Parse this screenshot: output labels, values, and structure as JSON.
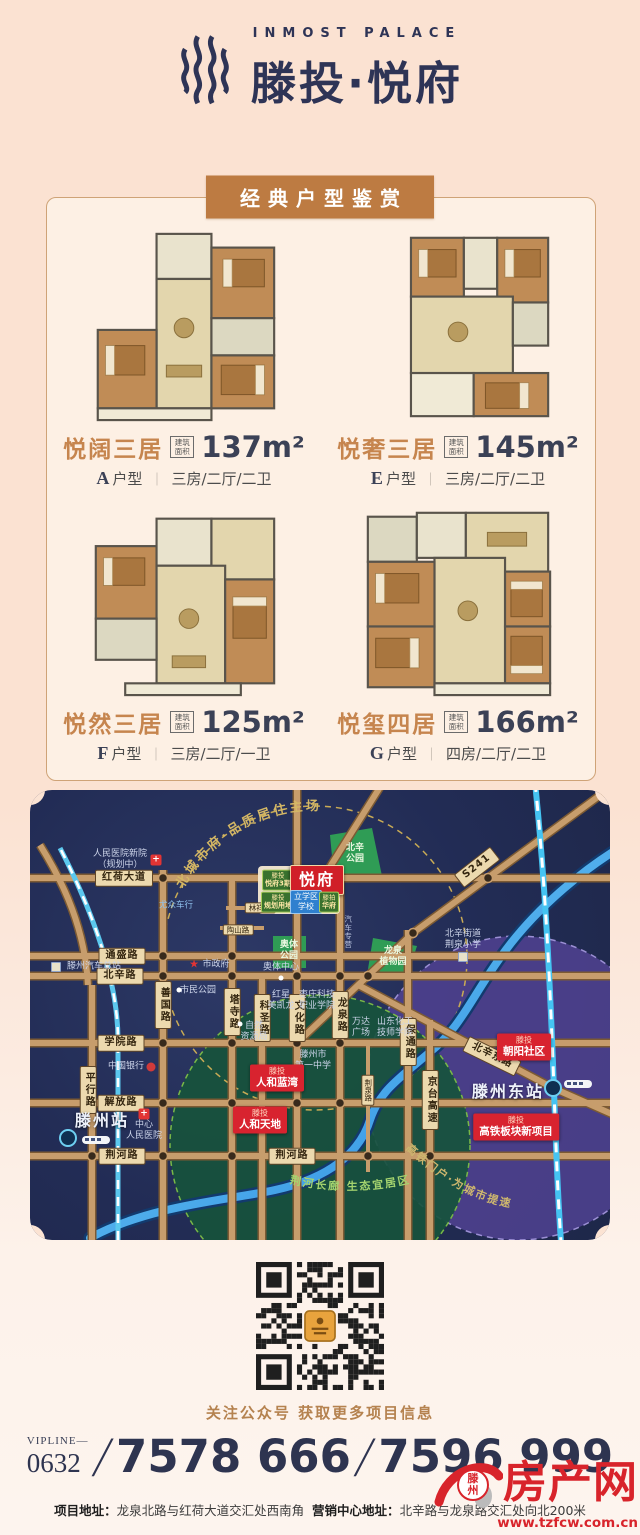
{
  "header": {
    "logo_en": "INMOST PALACE",
    "logo_cn": "滕投·悦府"
  },
  "section": {
    "banner": "经典户型鉴赏"
  },
  "units": [
    {
      "name": "悦阔三居",
      "area_badge": "建筑面积",
      "area": "137m²",
      "type_letter": "A",
      "type_word": "户型",
      "sep": "｜",
      "layout": "三房/二厅/二卫"
    },
    {
      "name": "悦奢三居",
      "area_badge": "建筑面积",
      "area": "145m²",
      "type_letter": "E",
      "type_word": "户型",
      "sep": "｜",
      "layout": "三房/二厅/二卫"
    },
    {
      "name": "悦然三居",
      "area_badge": "建筑面积",
      "area": "125m²",
      "type_letter": "F",
      "type_word": "户型",
      "sep": "｜",
      "layout": "三房/二厅/一卫"
    },
    {
      "name": "悦玺四居",
      "area_badge": "建筑面积",
      "area": "166m²",
      "type_letter": "G",
      "type_word": "户型",
      "sep": "｜",
      "layout": "四房/二厅/二卫"
    }
  ],
  "map": {
    "arc_top": "北城市府·品质居住主场",
    "arc_green": "荆河长廊 生态宜居区",
    "arc_purple": "高铁门户·为城市提速",
    "labels": [
      {
        "t": "红荷大道",
        "x": 94,
        "y": 88,
        "cls": "rp"
      },
      {
        "t": "通盛路",
        "x": 92,
        "y": 166,
        "cls": "rp"
      },
      {
        "t": "北辛路",
        "x": 90,
        "y": 186,
        "cls": "rp"
      },
      {
        "t": "学院路",
        "x": 91,
        "y": 253,
        "cls": "rp"
      },
      {
        "t": "解放路",
        "x": 91,
        "y": 313,
        "cls": "rp"
      },
      {
        "t": "荆河路",
        "x": 92,
        "y": 366,
        "cls": "rp"
      },
      {
        "t": "荆河路",
        "x": 262,
        "y": 366,
        "cls": "rp"
      },
      {
        "t": "平行路",
        "x": 58,
        "y": 300,
        "cls": "rpv"
      },
      {
        "t": "善国路",
        "x": 133,
        "y": 215,
        "cls": "rpv"
      },
      {
        "t": "塔寺路",
        "x": 202,
        "y": 222,
        "cls": "rpv"
      },
      {
        "t": "科圣路",
        "x": 232,
        "y": 228,
        "cls": "rpv"
      },
      {
        "t": "文化路",
        "x": 267,
        "y": 228,
        "cls": "rpv"
      },
      {
        "t": "龙泉路",
        "x": 310,
        "y": 225,
        "cls": "rpv"
      },
      {
        "t": "保通路",
        "x": 378,
        "y": 252,
        "cls": "rpv"
      },
      {
        "t": "京台高速",
        "x": 400,
        "y": 310,
        "cls": "rpv"
      },
      {
        "t": "荆泉路",
        "x": 338,
        "y": 300,
        "cls": "rpv-s"
      },
      {
        "t": "林祥路",
        "x": 230,
        "y": 118,
        "cls": "rp-s"
      },
      {
        "t": "陶山路",
        "x": 208,
        "y": 140,
        "cls": "rp-s"
      },
      {
        "t": "S241",
        "x": 447,
        "y": 77,
        "cls": "rp",
        "rot": -38
      },
      {
        "t": "北辛东路",
        "x": 462,
        "y": 266,
        "cls": "rp",
        "rot": 26
      },
      {
        "t": "汽车专营",
        "x": 318,
        "y": 142,
        "cls": "tinyv"
      },
      {
        "t": "人民医院新院\n（规划中）",
        "x": 90,
        "y": 70,
        "cls": "poi"
      },
      {
        "t": "+",
        "x": 126,
        "y": 70,
        "cls": "ic-cross"
      },
      {
        "t": "尤众车行",
        "x": 146,
        "y": 116,
        "cls": "poi-bl"
      },
      {
        "t": "",
        "x": 26,
        "y": 177,
        "cls": "ic-sq"
      },
      {
        "t": "滕州汽车总站",
        "x": 64,
        "y": 177,
        "cls": "poi"
      },
      {
        "t": "★",
        "x": 164,
        "y": 174,
        "cls": "ic-star"
      },
      {
        "t": "市政府",
        "x": 186,
        "y": 175,
        "cls": "poi"
      },
      {
        "t": "",
        "x": 149,
        "y": 200,
        "cls": "ic-dot"
      },
      {
        "t": "市民公园",
        "x": 168,
        "y": 201,
        "cls": "poi"
      },
      {
        "t": "中国银行",
        "x": 96,
        "y": 277,
        "cls": "poi"
      },
      {
        "t": "",
        "x": 121,
        "y": 277,
        "cls": "ic-bank"
      },
      {
        "t": "+",
        "x": 114,
        "y": 324,
        "cls": "ic-cross"
      },
      {
        "t": "中心\n人民医院",
        "x": 114,
        "y": 341,
        "cls": "poi"
      },
      {
        "t": "滕州站",
        "x": 72,
        "y": 331,
        "cls": "poi-b"
      },
      {
        "t": "",
        "x": 210,
        "y": 234,
        "cls": "ic-dot"
      },
      {
        "t": "自然\n资源局",
        "x": 224,
        "y": 242,
        "cls": "poi"
      },
      {
        "t": "红星\n美凯龙",
        "x": 251,
        "y": 211,
        "cls": "poi"
      },
      {
        "t": "枣庄科技\n职业学院",
        "x": 287,
        "y": 211,
        "cls": "poi"
      },
      {
        "t": "万达\n广场",
        "x": 331,
        "y": 238,
        "cls": "poi"
      },
      {
        "t": "山东化工\n技师学院",
        "x": 365,
        "y": 238,
        "cls": "poi"
      },
      {
        "t": "滕州市\n第一中学",
        "x": 283,
        "y": 271,
        "cls": "poi"
      },
      {
        "t": "北辛街道\n荆泉小学",
        "x": 433,
        "y": 150,
        "cls": "poi"
      },
      {
        "t": "",
        "x": 433,
        "y": 167,
        "cls": "ic-sq"
      },
      {
        "t": "奥体中心",
        "x": 251,
        "y": 178,
        "cls": "poi"
      },
      {
        "t": "",
        "x": 251,
        "y": 188,
        "cls": "ic-dot"
      },
      {
        "t": "北辛\n公园",
        "x": 325,
        "y": 64,
        "cls": "pk"
      },
      {
        "t": "奥体\n公园",
        "x": 259,
        "y": 161,
        "cls": "pk"
      },
      {
        "t": "龙泉\n植物园",
        "x": 363,
        "y": 167,
        "cls": "pk"
      },
      {
        "t": "滕州东站",
        "x": 478,
        "y": 302,
        "cls": "poi-b"
      },
      {
        "t1": "滕投",
        "t2": "人和蓝湾",
        "x": 247,
        "y": 288,
        "cls": "br"
      },
      {
        "t1": "滕投",
        "t2": "人和天地",
        "x": 230,
        "y": 330,
        "cls": "br"
      },
      {
        "t1": "滕投",
        "t2": "朝阳社区",
        "x": 494,
        "y": 257,
        "cls": "br"
      },
      {
        "t1": "滕投",
        "t2": "高铁板块新项目",
        "x": 486,
        "y": 337,
        "cls": "br"
      },
      {
        "t1": "滕投",
        "t2": "悦府3期",
        "x": 248,
        "y": 90,
        "cls": "bg1"
      },
      {
        "t": "悦府",
        "x": 287,
        "y": 90,
        "cls": "bp"
      },
      {
        "t1": "滕投",
        "t2": "规划用地",
        "x": 248,
        "y": 112,
        "cls": "bg1"
      },
      {
        "t": "立学区\n学校",
        "x": 276,
        "y": 112,
        "cls": "bb"
      },
      {
        "t1": "滕拍",
        "t2": "华府",
        "x": 299,
        "y": 112,
        "cls": "bg1"
      }
    ]
  },
  "qr_caption": "关注公众号  获取更多项目信息",
  "contact": {
    "vipline": "VIPLINE—",
    "code": "0632",
    "slash": "/",
    "phone1": "7578 666",
    "phone2": "7596 999",
    "addr1_label": "项目地址：",
    "addr1": "龙泉北路与红荷大道交汇处西南角",
    "addr2_label": "营销中心地址：",
    "addr2": "北辛路与龙泉路交汇处向北200米"
  },
  "watermark": {
    "site": "滕州",
    "name": "房产网",
    "url": "www.tzfcw.com.cn"
  }
}
